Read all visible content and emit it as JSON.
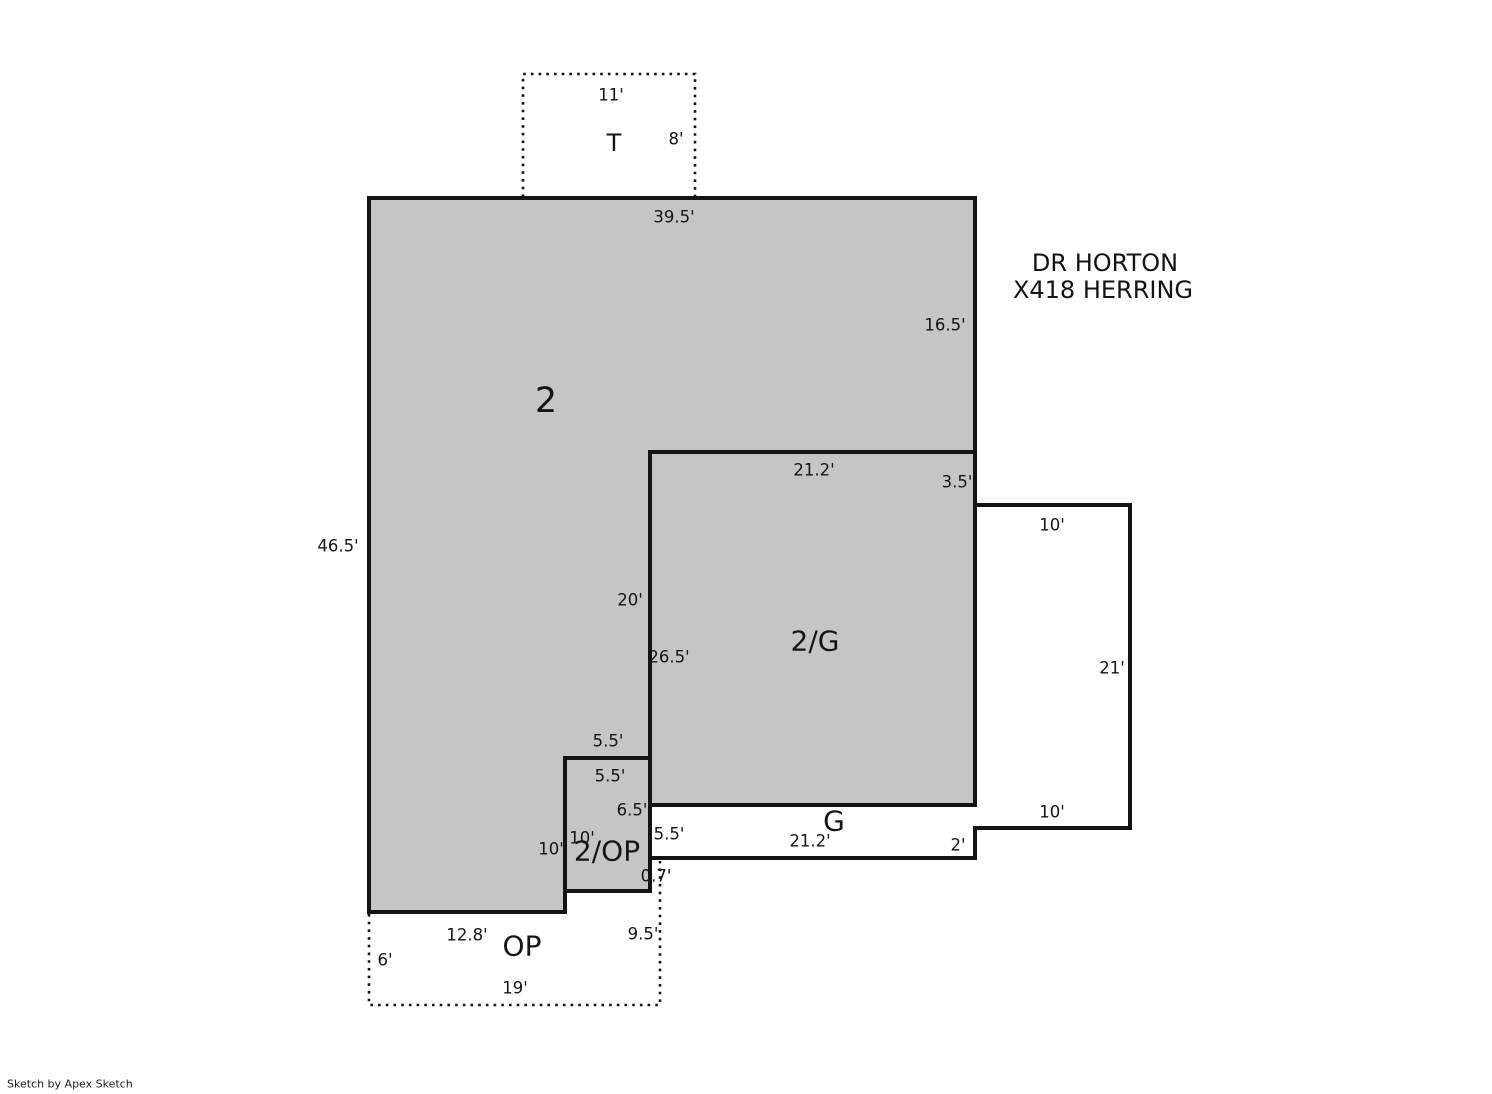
{
  "header": {
    "line1": "DR HORTON",
    "line2": "X418 HERRING"
  },
  "credit": "Sketch by Apex Sketch",
  "colors": {
    "area_fill": "#c5c5c5",
    "open_fill": "#ffffff",
    "line": "#141414"
  },
  "areas": {
    "second_floor": {
      "label": "2"
    },
    "second_over_garage": {
      "label": "2/G"
    },
    "garage": {
      "label": "G"
    },
    "second_over_open_porch": {
      "label": "2/OP"
    },
    "open_porch": {
      "label": "OP"
    },
    "terrace": {
      "label": "T"
    }
  },
  "dims": {
    "t_top": "11'",
    "t_right": "8'",
    "fl2_top": "39.5'",
    "fl2_right": "16.5'",
    "fl2_left": "46.5'",
    "fl2_inner_vert": "20'",
    "fl2_step_top": "5.5'",
    "fl2_step_left": "10'",
    "fl2_bottom": "12.8'",
    "g2_top": "21.2'",
    "g_right_upper": "3.5'",
    "g_left": "26.5'",
    "g_bottom": "21.2'",
    "g_step": "2'",
    "g_strip_left": "5.5'",
    "gext_top": "10'",
    "gext_right": "21'",
    "gext_bottom": "10'",
    "op2_top": "5.5'",
    "op2_right": "6.5'",
    "op2_left": "10'",
    "op_gap": "0.7'",
    "op_right": "9.5'",
    "op_left": "6'",
    "op_bottom": "19'"
  }
}
